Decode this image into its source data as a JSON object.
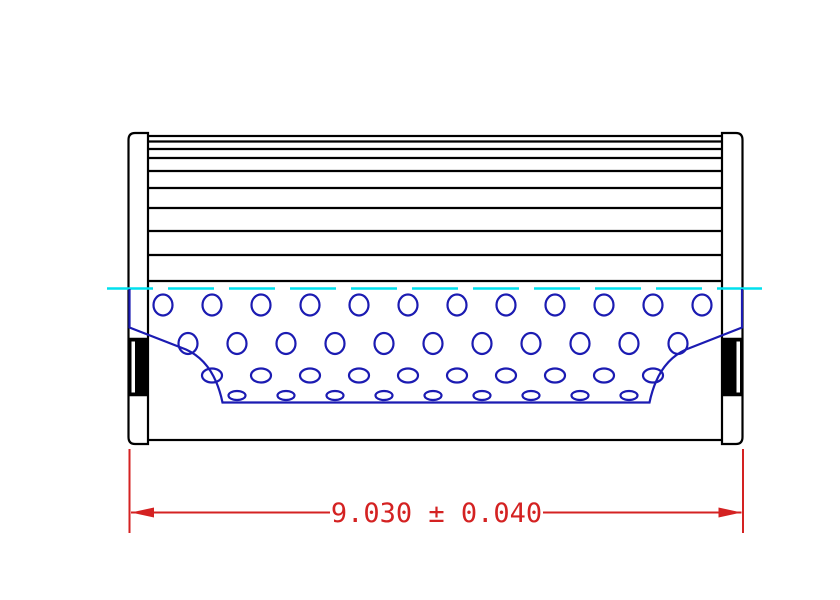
{
  "drawing": {
    "dimension": {
      "text": "9.030 ± 0.040",
      "value": "9.030",
      "plus_minus": "±",
      "tolerance": "0.040"
    },
    "colors": {
      "outline": "#000000",
      "core": "#1b1bb2",
      "centerline": "#00e0ee",
      "dimension": "#d42222",
      "background": "#ffffff"
    },
    "pleat_lines": {
      "y_positions": [
        141.5,
        149,
        158,
        171,
        188,
        208,
        231,
        255,
        281
      ]
    },
    "perforations": {
      "rows": [
        {
          "y": 305,
          "rx": 9.5,
          "ry": 10.5,
          "x_start": 163,
          "spacing": 49,
          "count": 12
        },
        {
          "y": 343.5,
          "rx": 9.5,
          "ry": 10.5,
          "x_start": 188,
          "spacing": 49,
          "count": 11
        },
        {
          "y": 375.5,
          "rx": 10,
          "ry": 7,
          "x_start": 212,
          "spacing": 49,
          "count": 10
        },
        {
          "y": 395.5,
          "rx": 8.5,
          "ry": 4.5,
          "x_start": 237,
          "spacing": 49,
          "count": 9
        }
      ]
    }
  }
}
